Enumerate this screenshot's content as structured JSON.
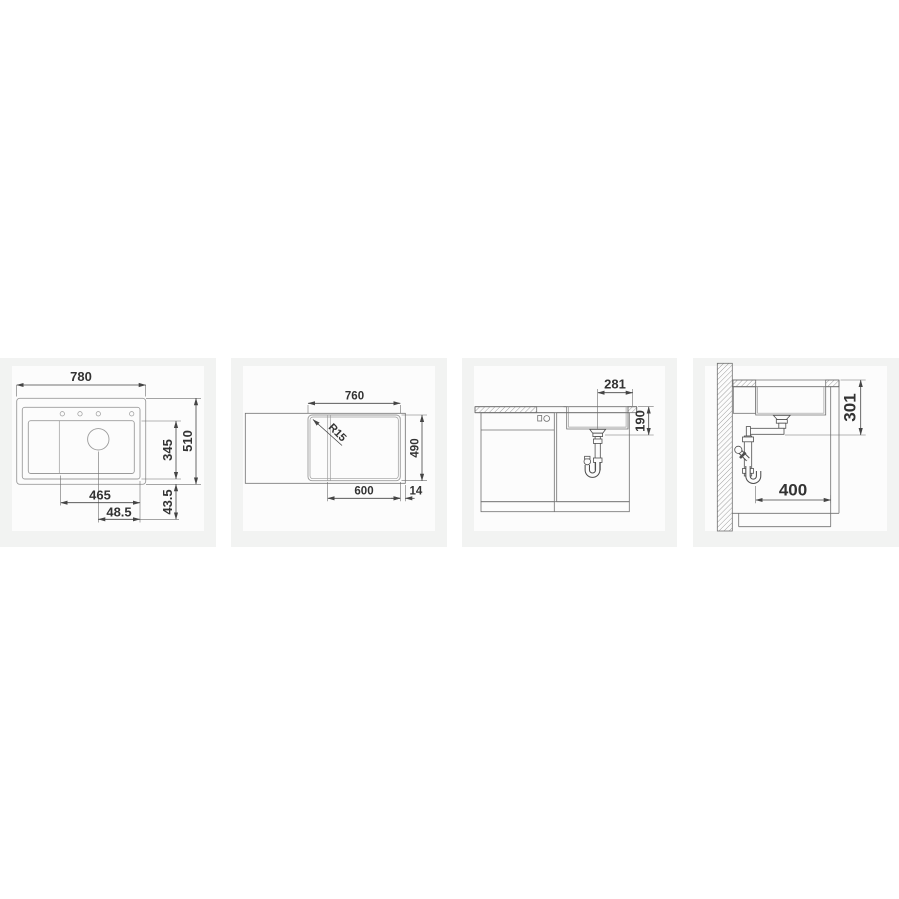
{
  "page": {
    "background": "#ffffff",
    "card_background": "#f2f3f2",
    "drawing_background": "#fcfcfc",
    "dimension_line_color": "#454545",
    "cabinet_line_color": "#707070",
    "sink_line_color": "#9b9b9b",
    "text_color": "#333333"
  },
  "panels": {
    "top_view": {
      "overall_width": "780",
      "bowl_width": "465",
      "drain_offset_right": "48.5",
      "bowl_depth_front_back": "345",
      "overall_depth": "510",
      "drain_offset_bottom": "43.5"
    },
    "cutout_view": {
      "cutout_width": "760",
      "corner_radius": "R15",
      "cutout_depth": "490",
      "bowl_zone_width": "600",
      "right_margin": "14"
    },
    "front_view": {
      "drain_center_from_right": "281",
      "bowl_depth": "190"
    },
    "side_view": {
      "drain_outlet_height": "301",
      "base_depth": "400"
    }
  }
}
